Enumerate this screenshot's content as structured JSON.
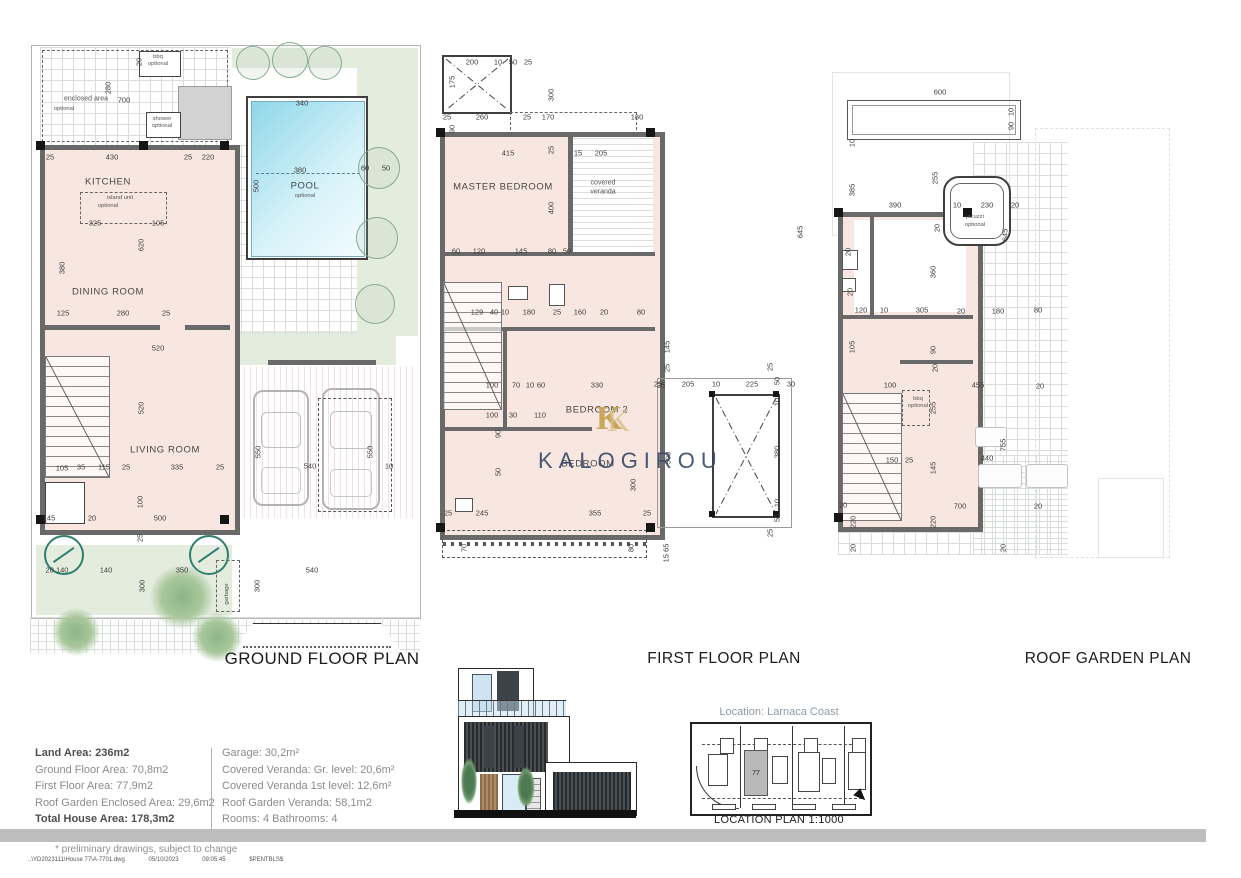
{
  "colors": {
    "room_fill": "#f8e7e1",
    "garden_green": "#e4ecde",
    "pool_blue": "#8fd7e8",
    "wall_gray": "#696969",
    "watermark_navy": "#394a69",
    "watermark_gold": "#c8a65c",
    "location_caption_gray": "#8d9aa6",
    "footer_bar_gray": "#bdbdbd"
  },
  "titles": {
    "ground": "GROUND FLOOR PLAN",
    "first": "FIRST FLOOR PLAN",
    "roof": "ROOF GARDEN PLAN"
  },
  "watermark": {
    "logo_letter": "K",
    "text": "KALOGIROU"
  },
  "location": {
    "caption": "Location: Larnaca Coast",
    "title": "LOCATION PLAN 1:1000",
    "plot": "77"
  },
  "area_table": {
    "left": [
      {
        "text": "Land Area: 236m2",
        "bold": true
      },
      {
        "text": "Ground Floor Area: 70,8m2",
        "bold": false
      },
      {
        "text": "First Floor Area: 77,9m2",
        "bold": false
      },
      {
        "text": "Roof Garden Enclosed Area: 29,6m2",
        "bold": false
      },
      {
        "text": "Total House Area: 178,3m2",
        "bold": true
      }
    ],
    "right": [
      {
        "text": "Garage: 30,2m²",
        "bold": false
      },
      {
        "text": "Covered Veranda: Gr. level: 20,6m²",
        "bold": false
      },
      {
        "text": "Covered Veranda 1st level: 12,6m²",
        "bold": false
      },
      {
        "text": "Roof Garden Veranda: 58,1m2",
        "bold": false
      },
      {
        "text": "Rooms: 4   Bathrooms: 4",
        "bold": false
      }
    ]
  },
  "footer": {
    "note": "* preliminary drawings, subject to change",
    "path": "..\\YD2023111\\House 77\\A-7701.dwg",
    "date": "05/10/2023",
    "time": "09:05:45",
    "code": "$PENTBLS$"
  },
  "labels": [
    [
      "20",
      139,
      62,
      "v"
    ],
    [
      "bbq",
      158,
      57,
      "o"
    ],
    [
      "optional",
      158,
      64,
      "o"
    ],
    [
      "700",
      124,
      100,
      "d"
    ],
    [
      "280",
      108,
      88,
      "v"
    ],
    [
      "enclosed area",
      86,
      99,
      "n"
    ],
    [
      "optional",
      64,
      109,
      "o"
    ],
    [
      "shower",
      162,
      119,
      "o"
    ],
    [
      "optional",
      162,
      126,
      "o"
    ],
    [
      "25",
      50,
      157,
      "d"
    ],
    [
      "430",
      112,
      157,
      "d"
    ],
    [
      "25",
      188,
      157,
      "d"
    ],
    [
      "220",
      208,
      157,
      "d"
    ],
    [
      "KITCHEN",
      108,
      182,
      "r"
    ],
    [
      "island unit",
      120,
      198,
      "o"
    ],
    [
      "optional",
      108,
      206,
      "o"
    ],
    [
      "325",
      95,
      223,
      "d"
    ],
    [
      "105",
      158,
      223,
      "d"
    ],
    [
      "380",
      62,
      268,
      "v"
    ],
    [
      "620",
      141,
      245,
      "v"
    ],
    [
      "DINING ROOM",
      108,
      292,
      "r"
    ],
    [
      "125",
      63,
      313,
      "d"
    ],
    [
      "280",
      123,
      313,
      "d"
    ],
    [
      "25",
      166,
      313,
      "d"
    ],
    [
      "520",
      158,
      348,
      "d"
    ],
    [
      "520",
      141,
      408,
      "v"
    ],
    [
      "LIVING ROOM",
      165,
      450,
      "r"
    ],
    [
      "105",
      62,
      468,
      "d"
    ],
    [
      "35",
      81,
      467,
      "d"
    ],
    [
      "115",
      104,
      467,
      "d"
    ],
    [
      "25",
      126,
      467,
      "d"
    ],
    [
      "335",
      177,
      467,
      "d"
    ],
    [
      "25",
      220,
      467,
      "d"
    ],
    [
      "145",
      49,
      518,
      "d"
    ],
    [
      "20",
      92,
      518,
      "d"
    ],
    [
      "500",
      160,
      518,
      "d"
    ],
    [
      "100",
      140,
      502,
      "v"
    ],
    [
      "25",
      140,
      538,
      "v"
    ],
    [
      "550",
      258,
      452,
      "v"
    ],
    [
      "550",
      370,
      452,
      "v"
    ],
    [
      "540",
      310,
      466,
      "d"
    ],
    [
      "10",
      389,
      466,
      "d"
    ],
    [
      "340",
      302,
      103,
      "d"
    ],
    [
      "500",
      256,
      186,
      "v"
    ],
    [
      "380",
      300,
      170,
      "d"
    ],
    [
      "POOL",
      305,
      186,
      "r"
    ],
    [
      "optional",
      305,
      196,
      "o"
    ],
    [
      "60",
      365,
      168,
      "d"
    ],
    [
      "50",
      386,
      168,
      "d"
    ],
    [
      "20 140",
      57,
      570,
      "d"
    ],
    [
      "140",
      106,
      570,
      "d"
    ],
    [
      "350",
      182,
      570,
      "d"
    ],
    [
      "540",
      312,
      570,
      "d"
    ],
    [
      "300",
      142,
      586,
      "v"
    ],
    [
      "300",
      257,
      586,
      "v"
    ],
    [
      "garbage",
      227,
      594,
      "ov"
    ],
    [
      "200",
      472,
      62,
      "d"
    ],
    [
      "10",
      498,
      62,
      "d"
    ],
    [
      "50",
      513,
      62,
      "d"
    ],
    [
      "25",
      528,
      62,
      "d"
    ],
    [
      "175",
      452,
      82,
      "v"
    ],
    [
      "300",
      551,
      95,
      "v"
    ],
    [
      "25",
      447,
      117,
      "d"
    ],
    [
      "260",
      482,
      117,
      "d"
    ],
    [
      "25",
      527,
      117,
      "d"
    ],
    [
      "170",
      548,
      117,
      "d"
    ],
    [
      "180",
      637,
      117,
      "d"
    ],
    [
      "90",
      452,
      129,
      "v"
    ],
    [
      "415",
      508,
      153,
      "d"
    ],
    [
      "25",
      551,
      150,
      "v"
    ],
    [
      "15",
      578,
      153,
      "d"
    ],
    [
      "205",
      601,
      153,
      "d"
    ],
    [
      "MASTER BEDROOM",
      503,
      187,
      "r"
    ],
    [
      "covered",
      603,
      183,
      "n"
    ],
    [
      "veranda",
      603,
      192,
      "n"
    ],
    [
      "400",
      551,
      208,
      "v"
    ],
    [
      "60",
      456,
      251,
      "d"
    ],
    [
      "120",
      479,
      251,
      "d"
    ],
    [
      "145",
      521,
      251,
      "d"
    ],
    [
      "80",
      552,
      251,
      "d"
    ],
    [
      "50",
      567,
      251,
      "d"
    ],
    [
      "645",
      800,
      232,
      "v"
    ],
    [
      "129",
      477,
      312,
      "d"
    ],
    [
      "40",
      494,
      312,
      "d"
    ],
    [
      "10",
      505,
      312,
      "d"
    ],
    [
      "180",
      529,
      312,
      "d"
    ],
    [
      "25",
      557,
      312,
      "d"
    ],
    [
      "160",
      580,
      312,
      "d"
    ],
    [
      "20",
      604,
      312,
      "d"
    ],
    [
      "80",
      641,
      312,
      "d"
    ],
    [
      "145",
      667,
      347,
      "v"
    ],
    [
      "25",
      667,
      368,
      "v"
    ],
    [
      "100",
      492,
      385,
      "d"
    ],
    [
      "70",
      516,
      385,
      "d"
    ],
    [
      "10",
      530,
      385,
      "d"
    ],
    [
      "60",
      541,
      385,
      "d"
    ],
    [
      "330",
      597,
      385,
      "d"
    ],
    [
      "25",
      661,
      385,
      "d"
    ],
    [
      "BEDROOM 2",
      597,
      410,
      "r"
    ],
    [
      "100",
      492,
      415,
      "d"
    ],
    [
      "30",
      513,
      415,
      "d"
    ],
    [
      "110",
      540,
      415,
      "d"
    ],
    [
      "90",
      498,
      434,
      "v"
    ],
    [
      "50",
      498,
      472,
      "v"
    ],
    [
      "BEDROOM",
      588,
      464,
      "r"
    ],
    [
      "355",
      595,
      513,
      "d"
    ],
    [
      "25",
      647,
      513,
      "d"
    ],
    [
      "300",
      633,
      485,
      "v"
    ],
    [
      "500",
      668,
      458,
      "v"
    ],
    [
      "25",
      448,
      513,
      "d"
    ],
    [
      "245",
      482,
      513,
      "d"
    ],
    [
      "70",
      464,
      548,
      "v"
    ],
    [
      "80",
      631,
      548,
      "v"
    ],
    [
      "15 65",
      666,
      553,
      "v"
    ],
    [
      "25",
      658,
      384,
      "d"
    ],
    [
      "205",
      688,
      384,
      "d"
    ],
    [
      "10",
      716,
      384,
      "d"
    ],
    [
      "225",
      752,
      384,
      "d"
    ],
    [
      "50",
      777,
      381,
      "v"
    ],
    [
      "30",
      791,
      384,
      "d"
    ],
    [
      "10",
      777,
      402,
      "v"
    ],
    [
      "380",
      777,
      452,
      "v"
    ],
    [
      "10",
      777,
      503,
      "v"
    ],
    [
      "50",
      777,
      518,
      "v"
    ],
    [
      "25",
      770,
      533,
      "v"
    ],
    [
      "25",
      770,
      367,
      "v"
    ],
    [
      "600",
      940,
      92,
      "d"
    ],
    [
      "10",
      1011,
      112,
      "v"
    ],
    [
      "90",
      1011,
      126,
      "v"
    ],
    [
      "10",
      852,
      143,
      "v"
    ],
    [
      "385",
      852,
      190,
      "v"
    ],
    [
      "390",
      895,
      205,
      "d"
    ],
    [
      "10",
      957,
      205,
      "d"
    ],
    [
      "230",
      987,
      205,
      "d"
    ],
    [
      "20",
      1015,
      205,
      "d"
    ],
    [
      "255",
      935,
      178,
      "v"
    ],
    [
      "20",
      937,
      228,
      "v"
    ],
    [
      "jacuzzi",
      975,
      217,
      "o"
    ],
    [
      "optional",
      975,
      225,
      "o"
    ],
    [
      "645",
      1005,
      235,
      "v"
    ],
    [
      "20",
      848,
      252,
      "v"
    ],
    [
      "20",
      850,
      292,
      "v"
    ],
    [
      "360",
      933,
      272,
      "v"
    ],
    [
      "120",
      861,
      310,
      "d"
    ],
    [
      "10",
      884,
      310,
      "d"
    ],
    [
      "305",
      922,
      310,
      "d"
    ],
    [
      "20",
      961,
      311,
      "d"
    ],
    [
      "180",
      998,
      311,
      "d"
    ],
    [
      "80",
      1038,
      310,
      "d"
    ],
    [
      "105",
      852,
      347,
      "v"
    ],
    [
      "90",
      933,
      350,
      "v"
    ],
    [
      "20",
      935,
      368,
      "v"
    ],
    [
      "100",
      890,
      385,
      "d"
    ],
    [
      "455",
      978,
      385,
      "d"
    ],
    [
      "20",
      1040,
      386,
      "d"
    ],
    [
      "255",
      933,
      408,
      "v"
    ],
    [
      "bbq",
      918,
      399,
      "o"
    ],
    [
      "optional",
      918,
      406,
      "o"
    ],
    [
      "150",
      892,
      460,
      "d"
    ],
    [
      "25",
      909,
      460,
      "d"
    ],
    [
      "145",
      933,
      468,
      "v"
    ],
    [
      "440",
      987,
      458,
      "d"
    ],
    [
      "755",
      1003,
      445,
      "v"
    ],
    [
      "700",
      960,
      506,
      "d"
    ],
    [
      "20",
      843,
      505,
      "d"
    ],
    [
      "20",
      1038,
      506,
      "d"
    ],
    [
      "220",
      853,
      522,
      "v"
    ],
    [
      "220",
      933,
      522,
      "v"
    ],
    [
      "20",
      853,
      548,
      "v"
    ],
    [
      "20",
      1003,
      548,
      "v"
    ]
  ]
}
